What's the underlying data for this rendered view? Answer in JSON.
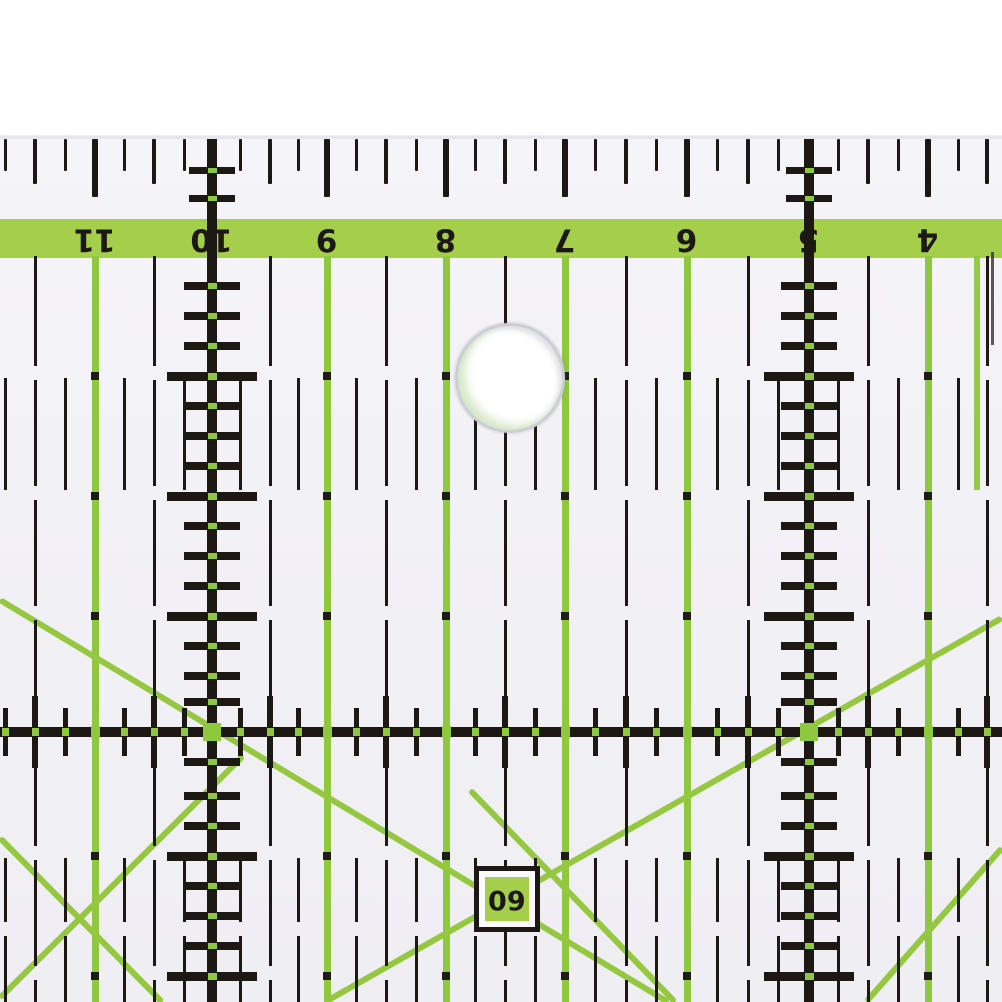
{
  "title": "transparent patchwork quilting ruler, macro photo, rotated 180 degrees",
  "colors": {
    "page_bg": "#ffffff",
    "ruler_body": "#f2f1f6",
    "band_green": "#a5cf4b",
    "line_green": "#8fc73e",
    "diag_green": "#95c840",
    "ink_black": "#1d1813",
    "dot_black": "#211b15",
    "hole_ring": "#ccced6",
    "hole_fill": "#ffffff",
    "box_bg": "#fbfbfd",
    "edge_dark": "#35302a"
  },
  "ruler": {
    "body_top": 136,
    "edge_tick_top": 139,
    "band": {
      "top": 219,
      "height": 39
    },
    "numbers": [
      {
        "label": "11",
        "x": 95,
        "type": "green"
      },
      {
        "label": "10",
        "x": 212,
        "type": "black"
      },
      {
        "label": "9",
        "x": 327,
        "type": "green"
      },
      {
        "label": "8",
        "x": 446,
        "type": "green"
      },
      {
        "label": "7",
        "x": 565,
        "type": "green"
      },
      {
        "label": "6",
        "x": 687,
        "type": "green"
      },
      {
        "label": "5",
        "x": 809,
        "type": "black"
      },
      {
        "label": "4",
        "x": 928,
        "type": "green"
      }
    ],
    "extra_green": {
      "x": 977,
      "y1": 256,
      "y2": 490
    },
    "edge_sliver": {
      "x": 991,
      "y1": 252,
      "y2": 345
    },
    "half_x": [
      35,
      154,
      270,
      386,
      505,
      626,
      748,
      868,
      987
    ],
    "quarter_x": [
      5,
      65,
      124,
      184,
      240,
      298,
      356,
      416,
      475,
      535,
      595,
      656,
      717,
      778,
      838,
      898,
      958
    ],
    "whole_rows": [
      376,
      496,
      616,
      856,
      976
    ],
    "minor_rows": [
      286,
      316,
      346,
      406,
      436,
      466,
      526,
      556,
      586,
      646,
      676,
      702,
      762,
      796,
      826,
      886,
      916,
      946
    ],
    "band_cross_rows": [
      170,
      198
    ],
    "thick_row_y": 732,
    "quarter_bands": [
      {
        "y1": 378,
        "y2": 490
      },
      {
        "y1": 858,
        "y2": 1002,
        "gap_at": 922
      }
    ],
    "hole": {
      "cx": 510,
      "cy": 378,
      "r": 55
    },
    "label_box": {
      "cx": 507,
      "cy": 899,
      "outer": 66,
      "inner": 44,
      "text": "60"
    },
    "diagonals": [
      {
        "x1": 0,
        "y1": 600,
        "x2": 668,
        "y2": 1002
      },
      {
        "x1": 325,
        "y1": 1002,
        "x2": 1002,
        "y2": 618
      },
      {
        "x1": 0,
        "y1": 838,
        "x2": 162,
        "y2": 1002
      },
      {
        "x1": 0,
        "y1": 998,
        "x2": 243,
        "y2": 756
      },
      {
        "x1": 470,
        "y1": 790,
        "x2": 675,
        "y2": 1002
      },
      {
        "x1": 1002,
        "y1": 848,
        "x2": 866,
        "y2": 1002
      }
    ]
  }
}
